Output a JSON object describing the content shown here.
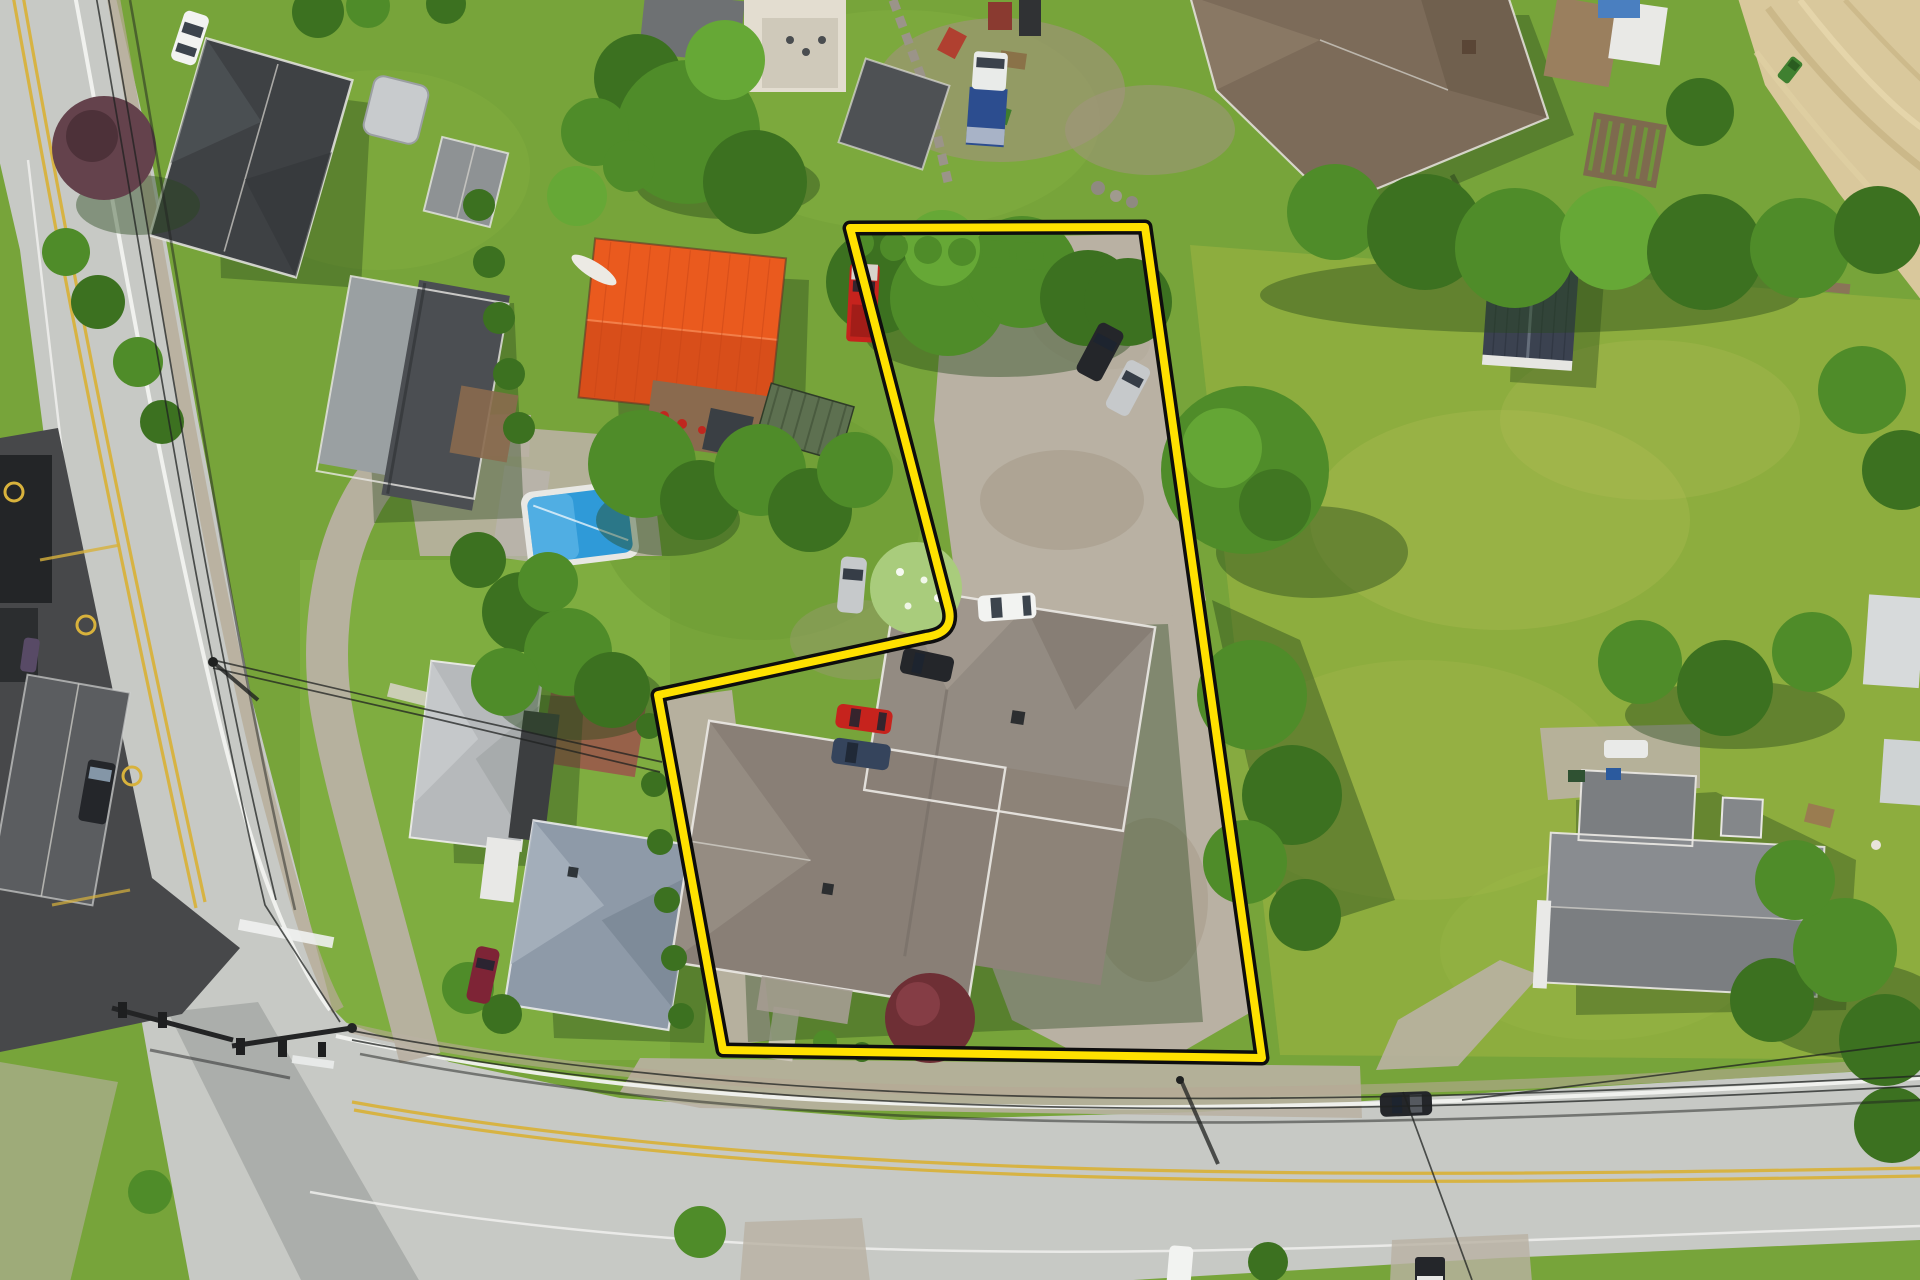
{
  "meta": {
    "kind": "aerial-drone-photograph",
    "subject": "residential property for sale with highlighted lot boundary",
    "canvas": {
      "width": 1920,
      "height": 1280
    },
    "visible_text": []
  },
  "palette": {
    "lawn": "#77a43a",
    "lawn-bright": "#86b545",
    "meadow": "#8fae3f",
    "meadow-patch": "#b8c05a",
    "road": "#c7c9c5",
    "road-dark": "#9da09c",
    "gravel": "#b9b1a3",
    "dirt": "#a4978546",
    "dirt-solid": "#a49785",
    "field-tan": "#d9c89c",
    "field-streak": "#c7b485",
    "field-streak-light": "#e7d8ae",
    "parking-dark": "#47484a",
    "tree-mid": "#4f8c29",
    "tree-dark": "#3c7120",
    "tree-light": "#66a836",
    "tree-flower": "#a9cc7c",
    "purple-tree": "#64424c",
    "purple-tree-dark": "#472d35",
    "burgundy-tree": "#6e2f35",
    "shadow": "#27481a",
    "white-line": "#f2f3f0",
    "yellow-line": "#d8b23c",
    "wire": "#1f2120",
    "boundary-yellow": "#ffe100",
    "boundary-black": "#0d0d0d",
    "pool-blue": "#2f9ad8",
    "pool-light": "#6cc0ec",
    "orange-roof": "#ea5a1e",
    "orange-roof-dark": "#c84517",
    "main-house-roof": "#938b82",
    "main-house-roof2": "#897f76",
    "charcoal-roof": "#3e4144",
    "slate-roof": "#4b4e52",
    "slate-roof-light": "#9aa0a2",
    "silver-roof": "#b6b9bb",
    "bluegray-roof": "#8e9aa8",
    "bluegray-roof-light": "#a7b1bd",
    "gray-roof-e": "#7b7e81",
    "brown-roof": "#7c6b59",
    "navy-shed": "#3b4250",
    "green-trailer": "#5d7050",
    "deck-wood": "#8a6a4e",
    "brick-patio": "#9a594a",
    "car-white": "#f2f3f1",
    "car-silver": "#c6c9cb",
    "car-black": "#24262a",
    "car-red": "#c6231d",
    "car-blue": "#35445c",
    "car-maroon": "#7e2436",
    "truck-blue": "#2c4d8f"
  },
  "scene": {
    "boundary_path": "M 850 228 L 1145 227 L 1262 1058 L 723 1050 L 658 695 L 926 637 Q 956 633 948 606 Z",
    "boundary_outer_width": "15",
    "boundary_inner_width": "8",
    "objects": [
      "vertical-street-left",
      "main-street-bottom",
      "signalized-intersection",
      "outlined-vacant-lot-with-house",
      "main-house-gray-hip-roof",
      "gravel-parking-areas",
      "orange-metal-barn",
      "pool-house",
      "inground-pool",
      "charcoal-roof-house-top-left",
      "silver-roof-house-west",
      "bluegray-roof-house-west",
      "gray-roof-house-east",
      "brown-roof-house-top-right",
      "navy-shed",
      "hay-field-top-right",
      "commercial-dark-parking-left",
      "meadow-east",
      "tree-rows",
      "purple-ornamental-tree",
      "burgundy-maple",
      "parked-cars",
      "power-lines",
      "traffic-signals",
      "garden-beds"
    ],
    "vehicle_count_visible": 17
  }
}
